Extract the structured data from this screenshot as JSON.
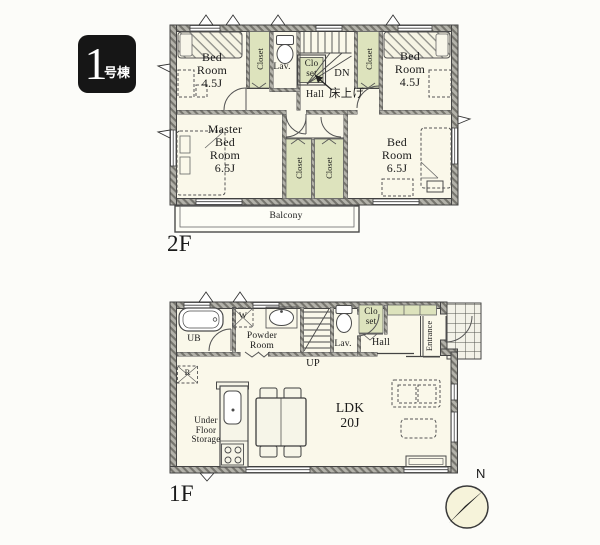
{
  "badge": {
    "number": "1",
    "suffix": "号棟"
  },
  "floor_2f": {
    "label": "2F",
    "bedroom_nw": "Bed\nRoom\n4.5J",
    "closet_nw": "Closet",
    "lavatory": "Lav.",
    "hall_closet": "Clo\nset",
    "stairs_down": "DN",
    "hall": "Hall",
    "raised_floor_note": "床上げ",
    "closet_ne": "Closet",
    "bedroom_ne": "Bed\nRoom\n4.5J",
    "master_bedroom": "Master\nBed\nRoom\n6.5J",
    "closet_master": "Closet",
    "closet_se": "Closet",
    "bedroom_se": "Bed\nRoom\n6.5J",
    "balcony": "Balcony"
  },
  "floor_1f": {
    "label": "1F",
    "unit_bath": "UB",
    "washer_mark": "W",
    "powder_room": "Powder\nRoom",
    "stairs_up": "UP",
    "lavatory": "Lav.",
    "hall_closet": "Clo\nset",
    "hall": "Hall",
    "entrance": "Entrance",
    "refrigerator_mark": "R",
    "under_floor_storage": "Under\nFloor\nStorage",
    "ldk": "LDK\n20J"
  },
  "compass": {
    "north": "N"
  },
  "colors": {
    "wall_hatch": "#75746d",
    "room_fill": "#faf8ea",
    "closet_fill": "#dde3bd",
    "badge_bg": "#161616",
    "compass_fill": "#f6f3da",
    "line": "#3c3c3c"
  }
}
